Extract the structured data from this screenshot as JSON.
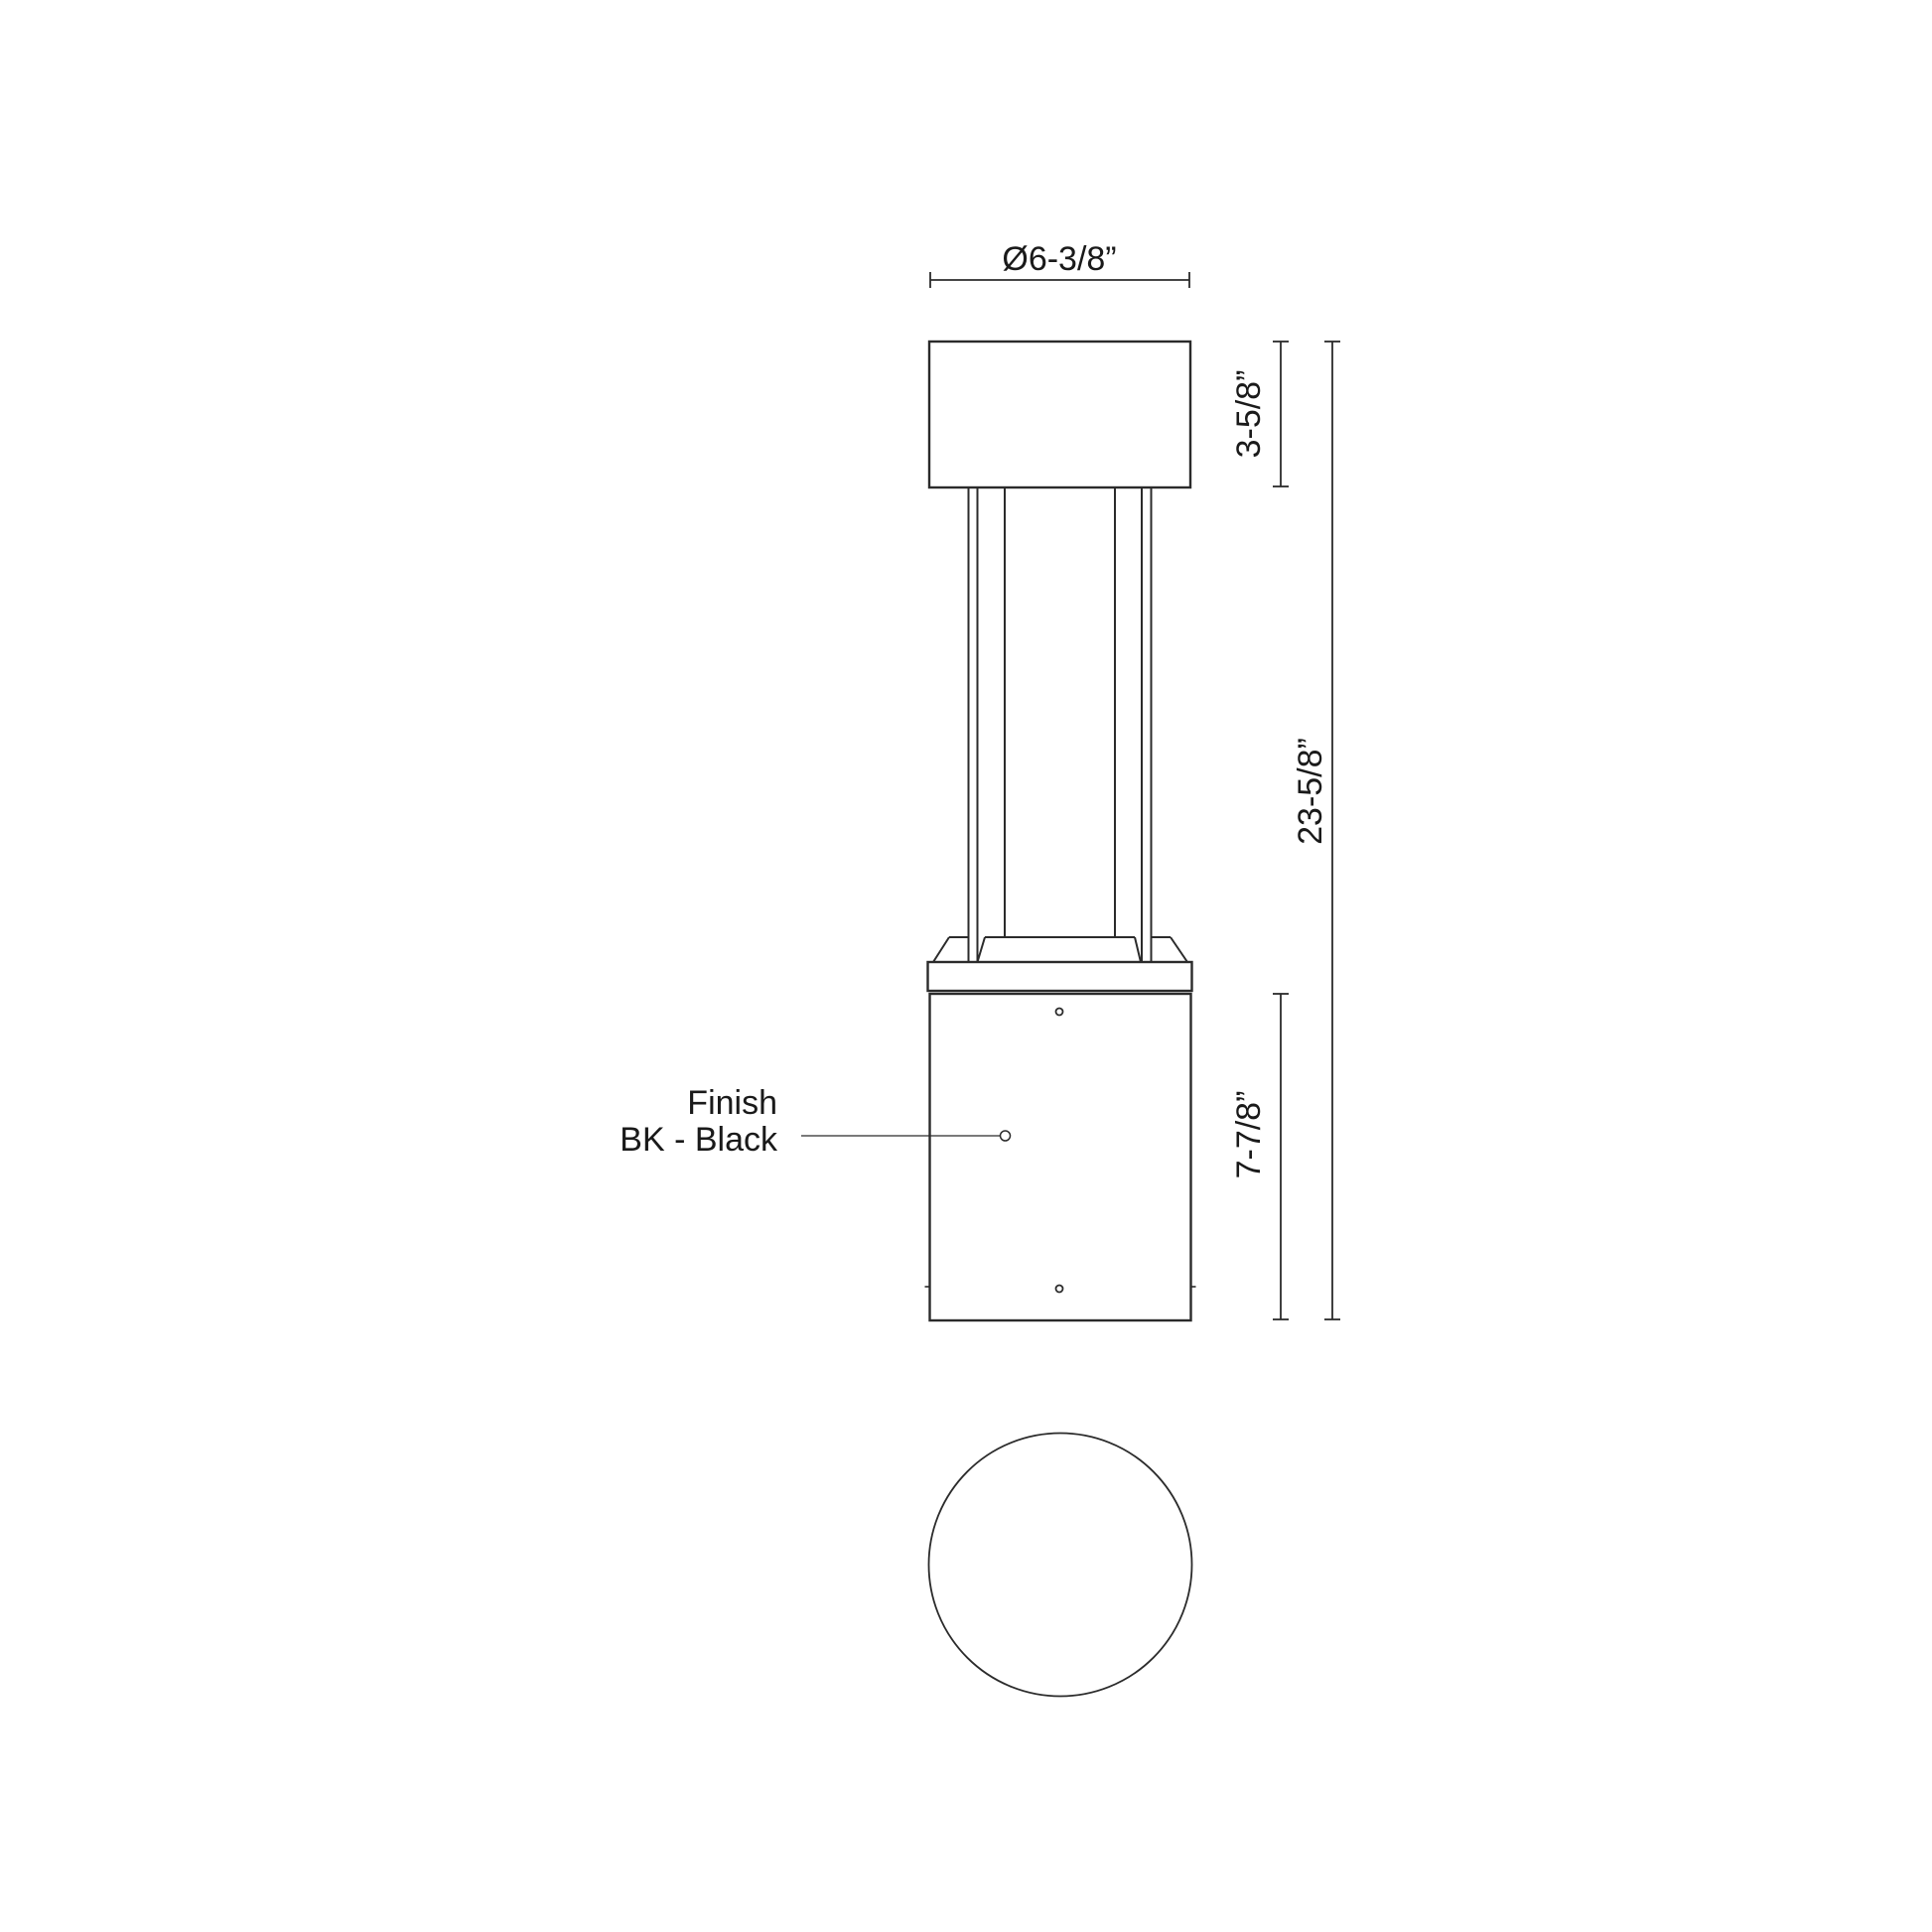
{
  "drawing": {
    "dimensions": {
      "diameter": "Ø6-3/8”",
      "cap_height": "3-5/8”",
      "overall_height": "23-5/8”",
      "base_height": "7-7/8”"
    },
    "finish": {
      "title": "Finish",
      "value": "BK - Black"
    },
    "colors": {
      "line": "#2b2b2b",
      "text": "#1a1a1a",
      "background": "#ffffff"
    }
  }
}
